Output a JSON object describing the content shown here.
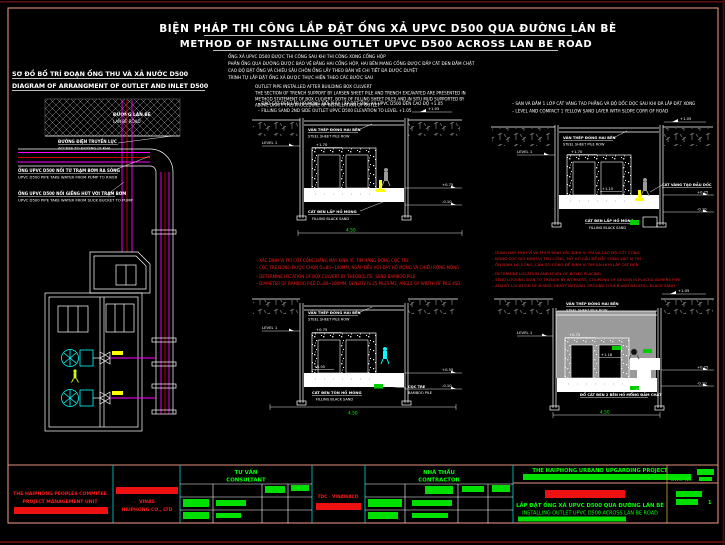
{
  "colors": {
    "background": "#000000",
    "frame_salmon": "#e2907e",
    "line_white": "#ffffff",
    "note_red": "#ff1a1a",
    "pipe_magenta": "#ff00ff",
    "pipe_red": "#cc0000",
    "pump_cyan": "#00ffff",
    "dim_green": "#00ff00",
    "worker_yellow": "#ffff00",
    "backfill_gray": "#9a9a9a"
  },
  "header": {
    "title_vi": "BIỆN PHÁP THI CÔNG LẮP ĐẶT ỐNG XẢ UPVC D500 QUA ĐƯỜNG LÁN BÈ",
    "title_en": "METHOD OF INSTALLING OUTLET UPVC D500 ACROSS LAN BE ROAD",
    "notes_vi": [
      "ỐNG XẢ UPVC D500 ĐƯỢC THI CÔNG SAU KHI THI CÔNG XONG CỐNG HỘP",
      "PHẦN ỐNG QUA ĐƯỜNG ĐƯỢC BẢO VỆ BẰNG HAI CỐNG HỘP, HAI BÊN MANG CỐNG ĐƯỢC ĐẮP CÁT ĐEN ĐẦM CHẶT",
      "CAO ĐỘ ĐẶT ỐNG VÀ CHIỀU SÂU CHÔN ỐNG LẤY THEO BẢN VẼ CHI TIẾT ĐÃ ĐƯỢC DUYỆT",
      "TRÌNH TỰ LẮP ĐẶT ỐNG XẢ ĐƯỢC THỰC HIỆN THEO CÁC BƯỚC SAU"
    ],
    "outlet_heading": "OUTLET PIPE INSTALLED AFTER BUILDING BOX CULVERT",
    "outlet_notes": [
      "THE SECTION OF TRENCH SUPPORT BY LARSEN SHEET PILE AND TRENCH EXCAVATED ARE PRESENTED IN",
      "METHOD STATEMENT OF BOX CULVERT, BOTH OF FILLING SHEET PILES AND IN SITU MUD SUPPORTED BY",
      "ABOVE DRAFT THIS PROCEDURE OF INSTALLATION OF OUTLET"
    ]
  },
  "left_diagram": {
    "title_vi": "SƠ ĐỒ BỐ TRÍ ĐOẠN ỐNG THU VÀ XẢ NƯỚC D500",
    "title_en": "DIAGRAM OF ARRANGMENT OF OUTLET AND INLET D500",
    "road_label_vi": "ĐƯỜNG LÁN BÈ",
    "road_label_en": "LAN BE ROAD",
    "label_access_vi": "ĐƯỜNG ĐIỆN TRUYỀN LỰC",
    "label_access_en": "ACCESS TO ĐƯỜNG LY KHA",
    "label_outlet_vi": "ỐNG UPVC D500 NỐI TỪ TRẠM BƠM RA SÔNG",
    "label_outlet_en": "UPVC D500 PIPE TAKE WATER FROM PUMP TO RIVER",
    "label_inlet_vi": "ỐNG UPVC D500 NỐI GIẾNG HÚT VỚI TRẠM BƠM",
    "label_inlet_en": "UPVC D500 PIPE TAKE WATER FROM SUCK BUCKET TO PUMP"
  },
  "sections": {
    "common": {
      "sheet_pile_vi": "VÁN THÉP ĐÓNG HAI BÊN",
      "sheet_pile_en": "STEEL SHEET PILE ROW",
      "black_sand_vi": "CÁT ĐEN LẤP HỐ MÓNG",
      "black_sand_en": "FILLING BLACK SAND",
      "level_ref": "LEVEL 1",
      "dim": "4.50"
    },
    "s1": {
      "note_vi": "– ĐÀO CÁT ĐEN LẤP HỐ MÓNG ĐỒI PHÍA LẮP ĐẶT ỐNG XẢ UPVC D500 ĐẾN CAO ĐỘ +1.05",
      "note_en": "– FILLING SAND 2ND SIDE OUTLET UPVC D500 ELEVATION TO LEVEL +1.05",
      "lv_top": "+1.70",
      "lv_bottom": "+0.20",
      "lv_flag": "+1.05",
      "lv_r1": "+0.75",
      "lv_r2": "-0.10"
    },
    "s2": {
      "note_vi": "– SAN VÀ ĐẦM 1 LỚP CÁT VÀNG TẠO PHẲNG VÀ ĐỘ DỐC DỌC SAU KHI ĐÃ LẮP ĐẶT XONG",
      "note_en": "– LEVEL AND COMPACT 1 YELLOW SAND LAYER WITH SLOPE CORR OF ROAD",
      "lv_top": "+1.70",
      "lv_mid": "+1.15",
      "lv_flag": "+1.05",
      "lv_r1": "+0.25",
      "lv_r2": "-0.10",
      "yellow_sand_vi": "CÁT VÀNG TẠO ĐẦU DỐC"
    },
    "s3": {
      "lv_top": "+0.75",
      "lv_bottom": "+0.05",
      "lv_r1": "+0.55",
      "lv_r2": "-0.10",
      "bamboo_vi": "CỌC TRE",
      "bamboo_en": "BAMBOO PILE",
      "fill_vi": "CÁT ĐEN TÔN HỐ MÓNG"
    },
    "s4": {
      "lv_top": "+0.75",
      "lv_mid": "+1.18",
      "lv_flag": "+1.05",
      "lv_r1": "+0.25",
      "lv_r2": "-0.10",
      "fill_vi": "ĐỔ CÁT ĐEN 2 BÊN HỐ MÓNG ĐẦM CHẶT"
    }
  },
  "red_notes_1": [
    "– XÁC ĐỊNH VỊ TRÍ CỐT CỐNG BẰNG MÁY KINH VĨ, TIM HÀNG ĐÓNG CỌC TRE",
    "– CỌC TRE ĐÓNG ĐƯỢC CHỌN D=80~100MM, NGẬP ĐỀU VỚI ĐÁY HỐ MÓNG VÀ CHIỀU RỘNG MÓNG",
    "– DETERMINE LOCATION OF BOX CULVERT BY THEODOLITE, SEND BAMBOO PILE",
    "– DIAMETER OF BAMBOO PILE D=80~100MM, DENSITY IS 25 PILES/M2, ANGLE OF WIDTH OF PILE 45D"
  ],
  "red_notes_2": [
    "– DÙNG MÁY KINH VĨ VÀ THUỶ BÌNH XÁC ĐỊNH VỊ TRÍ VÀ CAO ĐỘ CỐT CỐNG",
    "– ĐÓNG CỌC GIỮ ĐỊNH VỊ TRỤ CỐNG, MỞ HỐ CẨU ĐỂ ĐẶT CỐNG VÀO VỊ TRÍ",
    "– ỔN ĐỊNH LẠI CỐNG, CĂN DO CỐNG ĐỂ ĐỊNH VỊ TIM SAU KHI LẤP CÁT ĐEN",
    "– DETERMINE LOCATION AND LEVEL OF BOXES PLACING",
    "– SEND LOCKING SIGN TO TRENCH BY WORKERS, COUPLING OF DESIGN IS PLACED ADHERE PIPE",
    "– ADJUST LOCATION OF BOXES, HEAVY NATURAL GROUND OTHER AND BACKFILL BLACK SAND"
  ],
  "titleblock": {
    "employer_1": "THE HAIPHONG PEOPLES COMMITEE",
    "employer_2": "PROJECT MANAGEMENT UNIT",
    "vinas_1": "VINAS",
    "vinas_2": "HAIPHONG CO., LTD",
    "consultant_vi": "TƯ VẤN",
    "consultant_en": "CONSULTANT",
    "tdc": "TDC - VINAWACO",
    "contractor_vi": "NHÀ THẦU",
    "contractor_en": "CONTRACTOR",
    "project": "THE HAIPHONG URBANO UPGARDING PROJECT",
    "dwg_label": "DWG. No.",
    "dwg_no": "1",
    "drawing_vi": "LẮP ĐẶT ỐNG XẢ UPVC D500 QUA ĐƯỜNG LÁN BÈ",
    "drawing_en": "INSTALLING OUTLET UPVC D500 ACROSS LAN BE ROAD"
  }
}
